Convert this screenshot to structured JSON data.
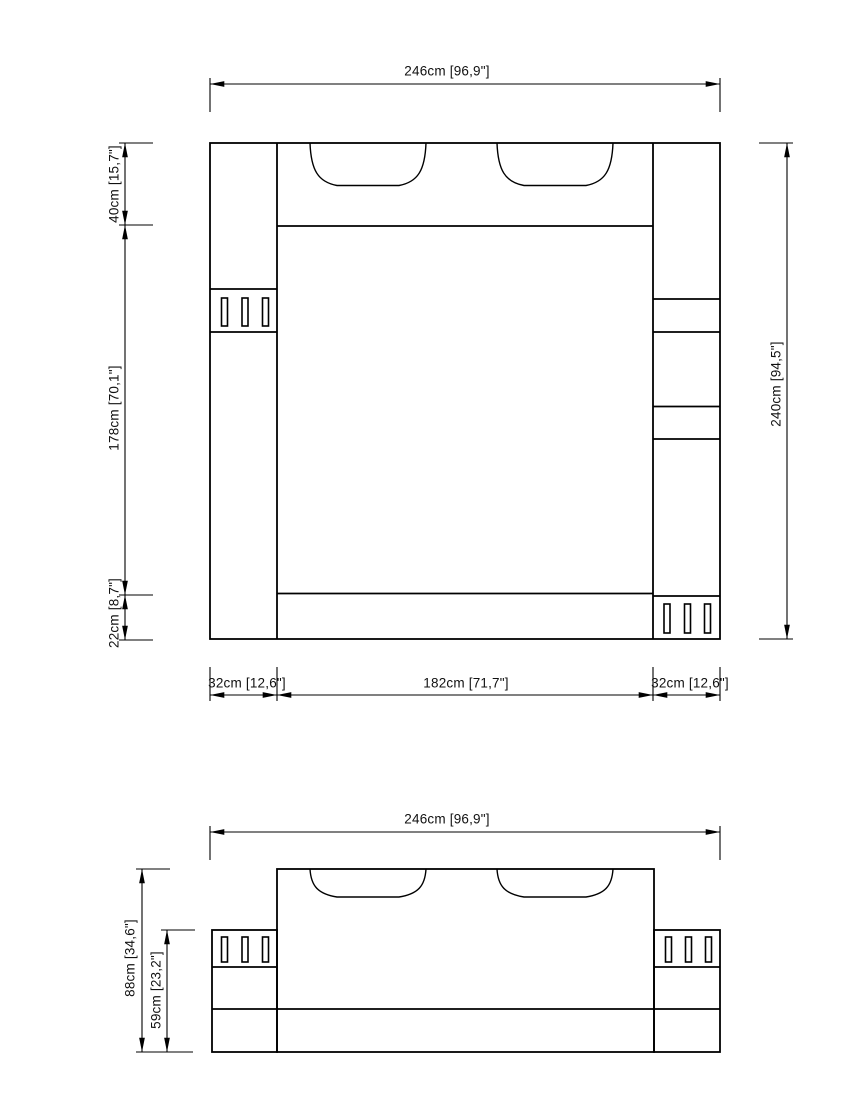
{
  "page": {
    "background_color": "#ffffff",
    "line_color": "#000000",
    "text_color": "#111111"
  },
  "top_view": {
    "name": "bed-top-view",
    "dimensions": {
      "overall_width": "246cm [96,9\"]",
      "overall_depth": "240cm [94,5\"]",
      "headboard_depth": "40cm [15,7\"]",
      "bed_length": "178cm [70,1\"]",
      "footboard_depth": "22cm [8,7\"]",
      "left_cabinet_width": "32cm [12,6\"]",
      "bed_width": "182cm [71,7\"]",
      "right_cabinet_width": "32cm [12,6\"]"
    }
  },
  "front_view": {
    "name": "bed-front-view",
    "dimensions": {
      "overall_width": "246cm [96,9\"]",
      "overall_height": "88cm [34,6\"]",
      "base_height": "59cm [23,2\"]"
    }
  }
}
